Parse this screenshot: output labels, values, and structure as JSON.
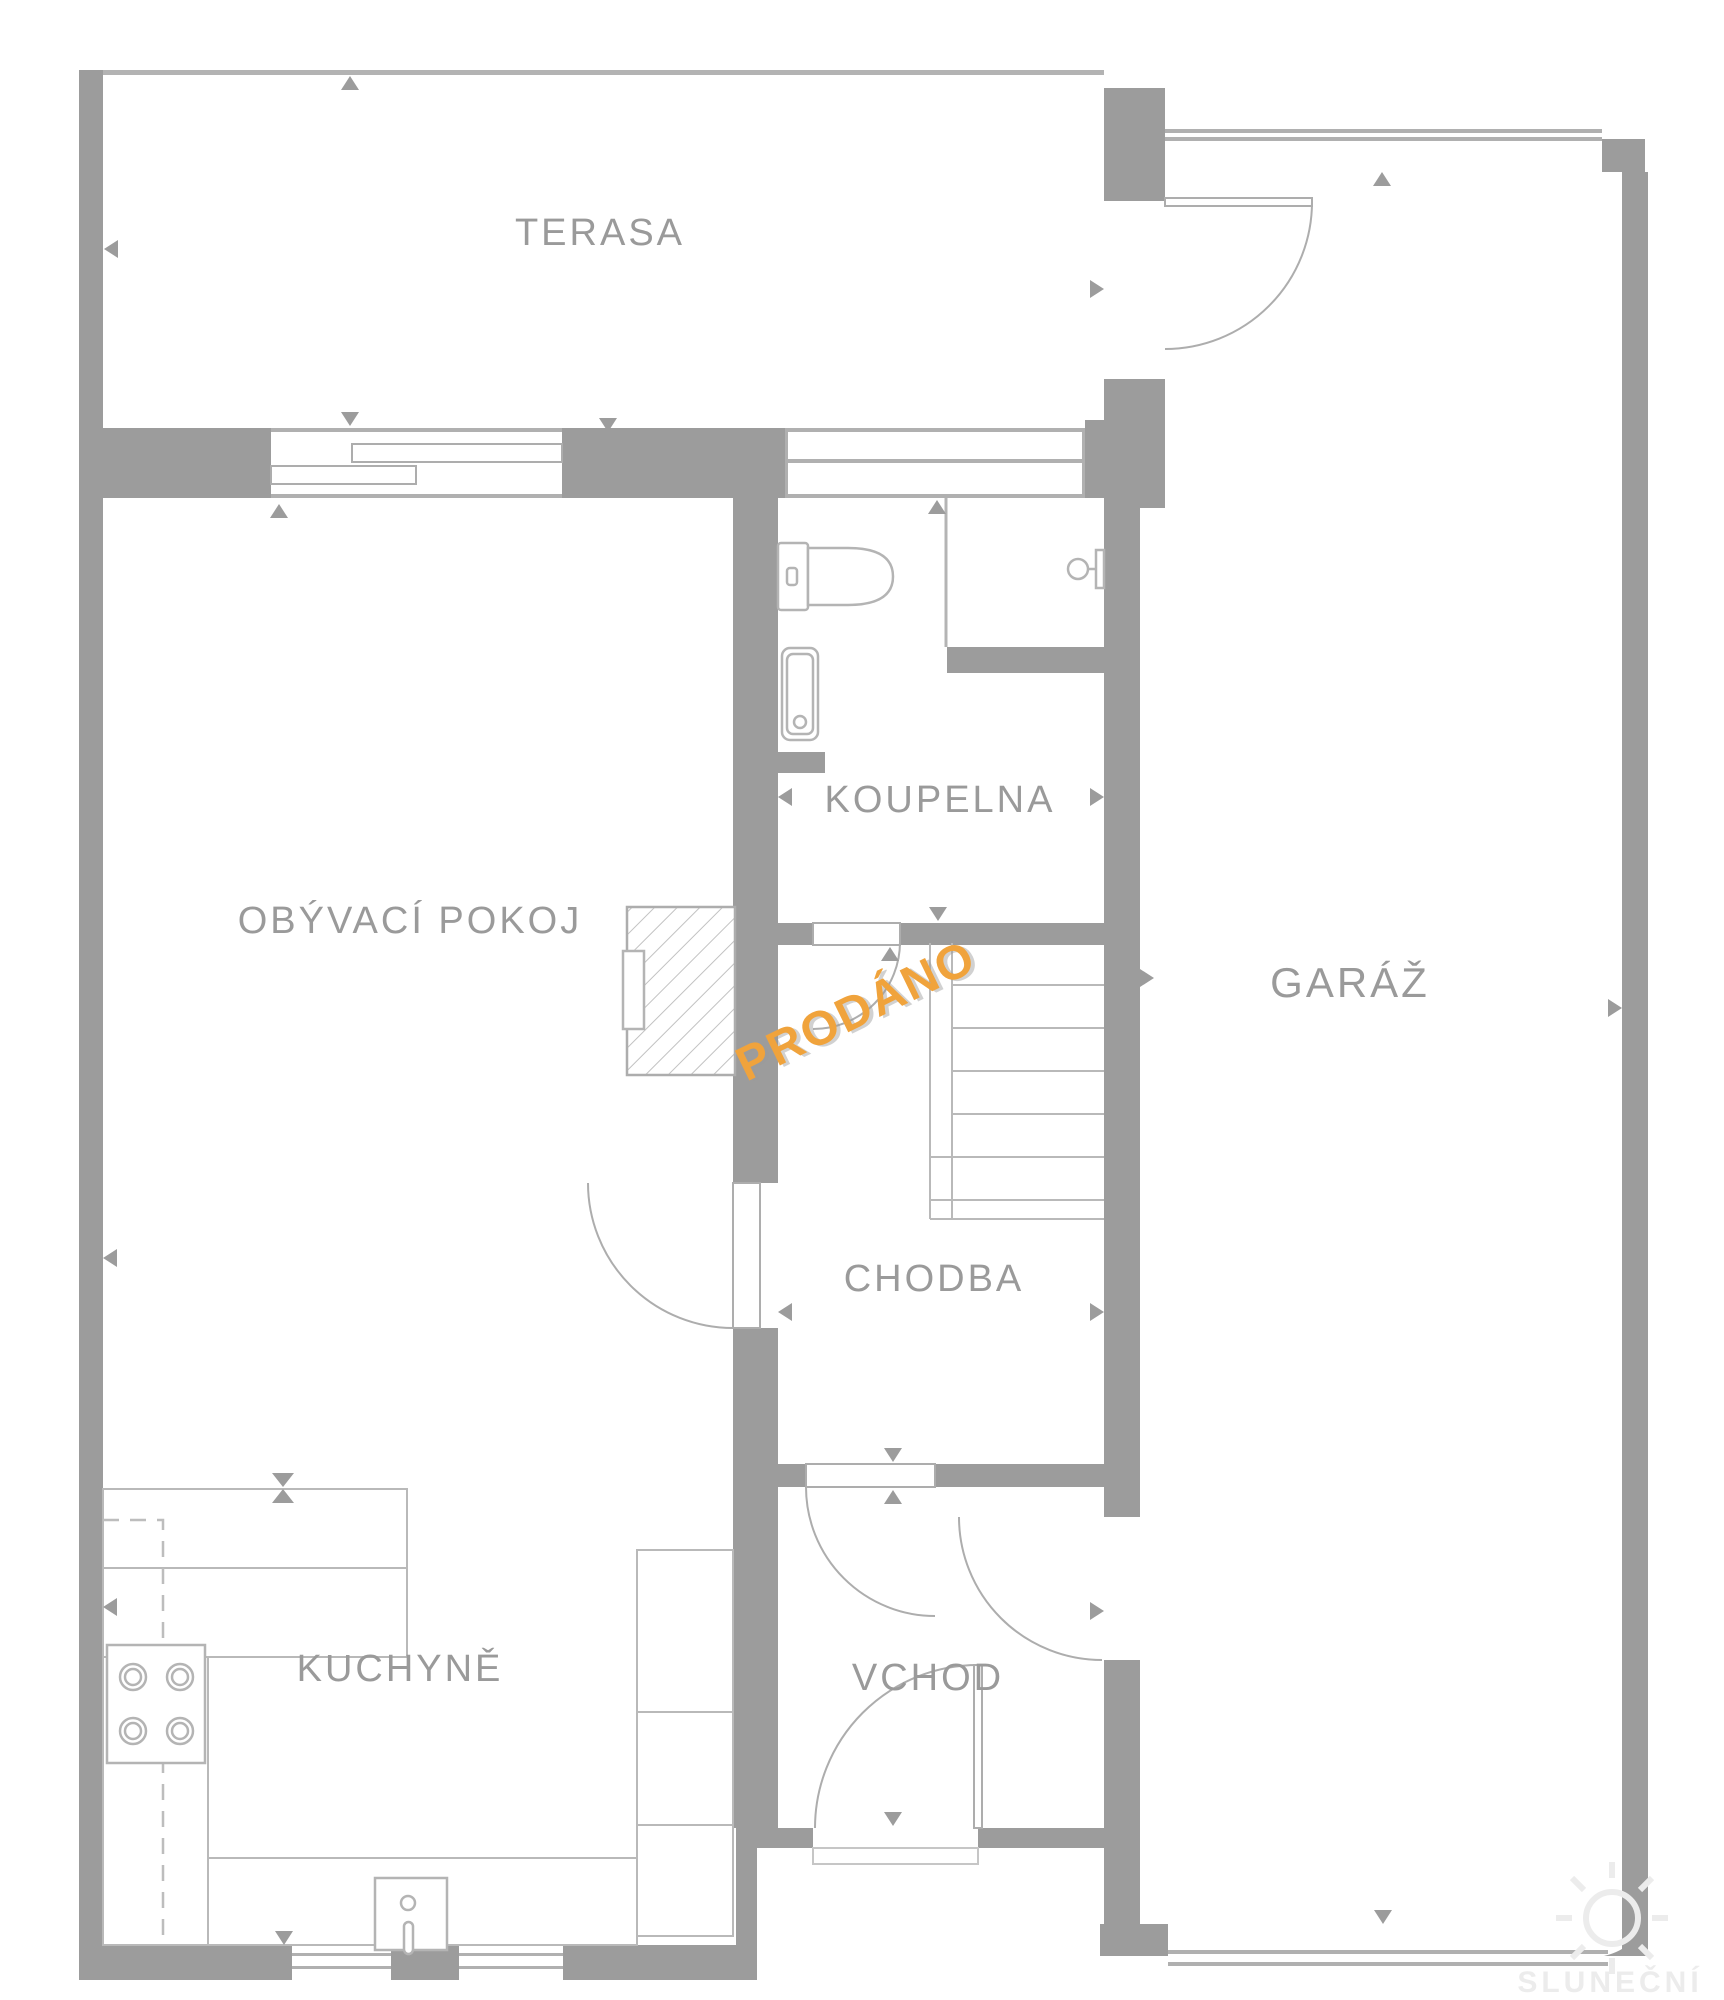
{
  "meta": {
    "kind": "floor-plan",
    "language": "cs"
  },
  "colors": {
    "background": "#FFFFFF",
    "wall": "#9C9C9C",
    "thin_line": "#ADADAD",
    "fixture_line": "#B4B4B4",
    "label": "#9A9A9A",
    "stamp_accent": "#F0A33C",
    "stamp_shadow": "#9B9B9B",
    "watermark": "#ECECEC"
  },
  "rooms": [
    {
      "id": "terasa",
      "label": "TERASA"
    },
    {
      "id": "obyvaci-pokoj",
      "label": "OBÝVACÍ POKOJ"
    },
    {
      "id": "koupelna",
      "label": "KOUPELNA"
    },
    {
      "id": "garaz",
      "label": "GARÁŽ"
    },
    {
      "id": "chodba",
      "label": "CHODBA"
    },
    {
      "id": "kuchyne",
      "label": "KUCHYNĚ"
    },
    {
      "id": "vchod",
      "label": "VCHOD"
    }
  ],
  "stamp": {
    "label": "PRODÁNO",
    "rotation_deg": -26,
    "color": "#F0A33C"
  },
  "watermark": {
    "line1": "SLUNEČNÍ",
    "line2": "REALITY"
  }
}
